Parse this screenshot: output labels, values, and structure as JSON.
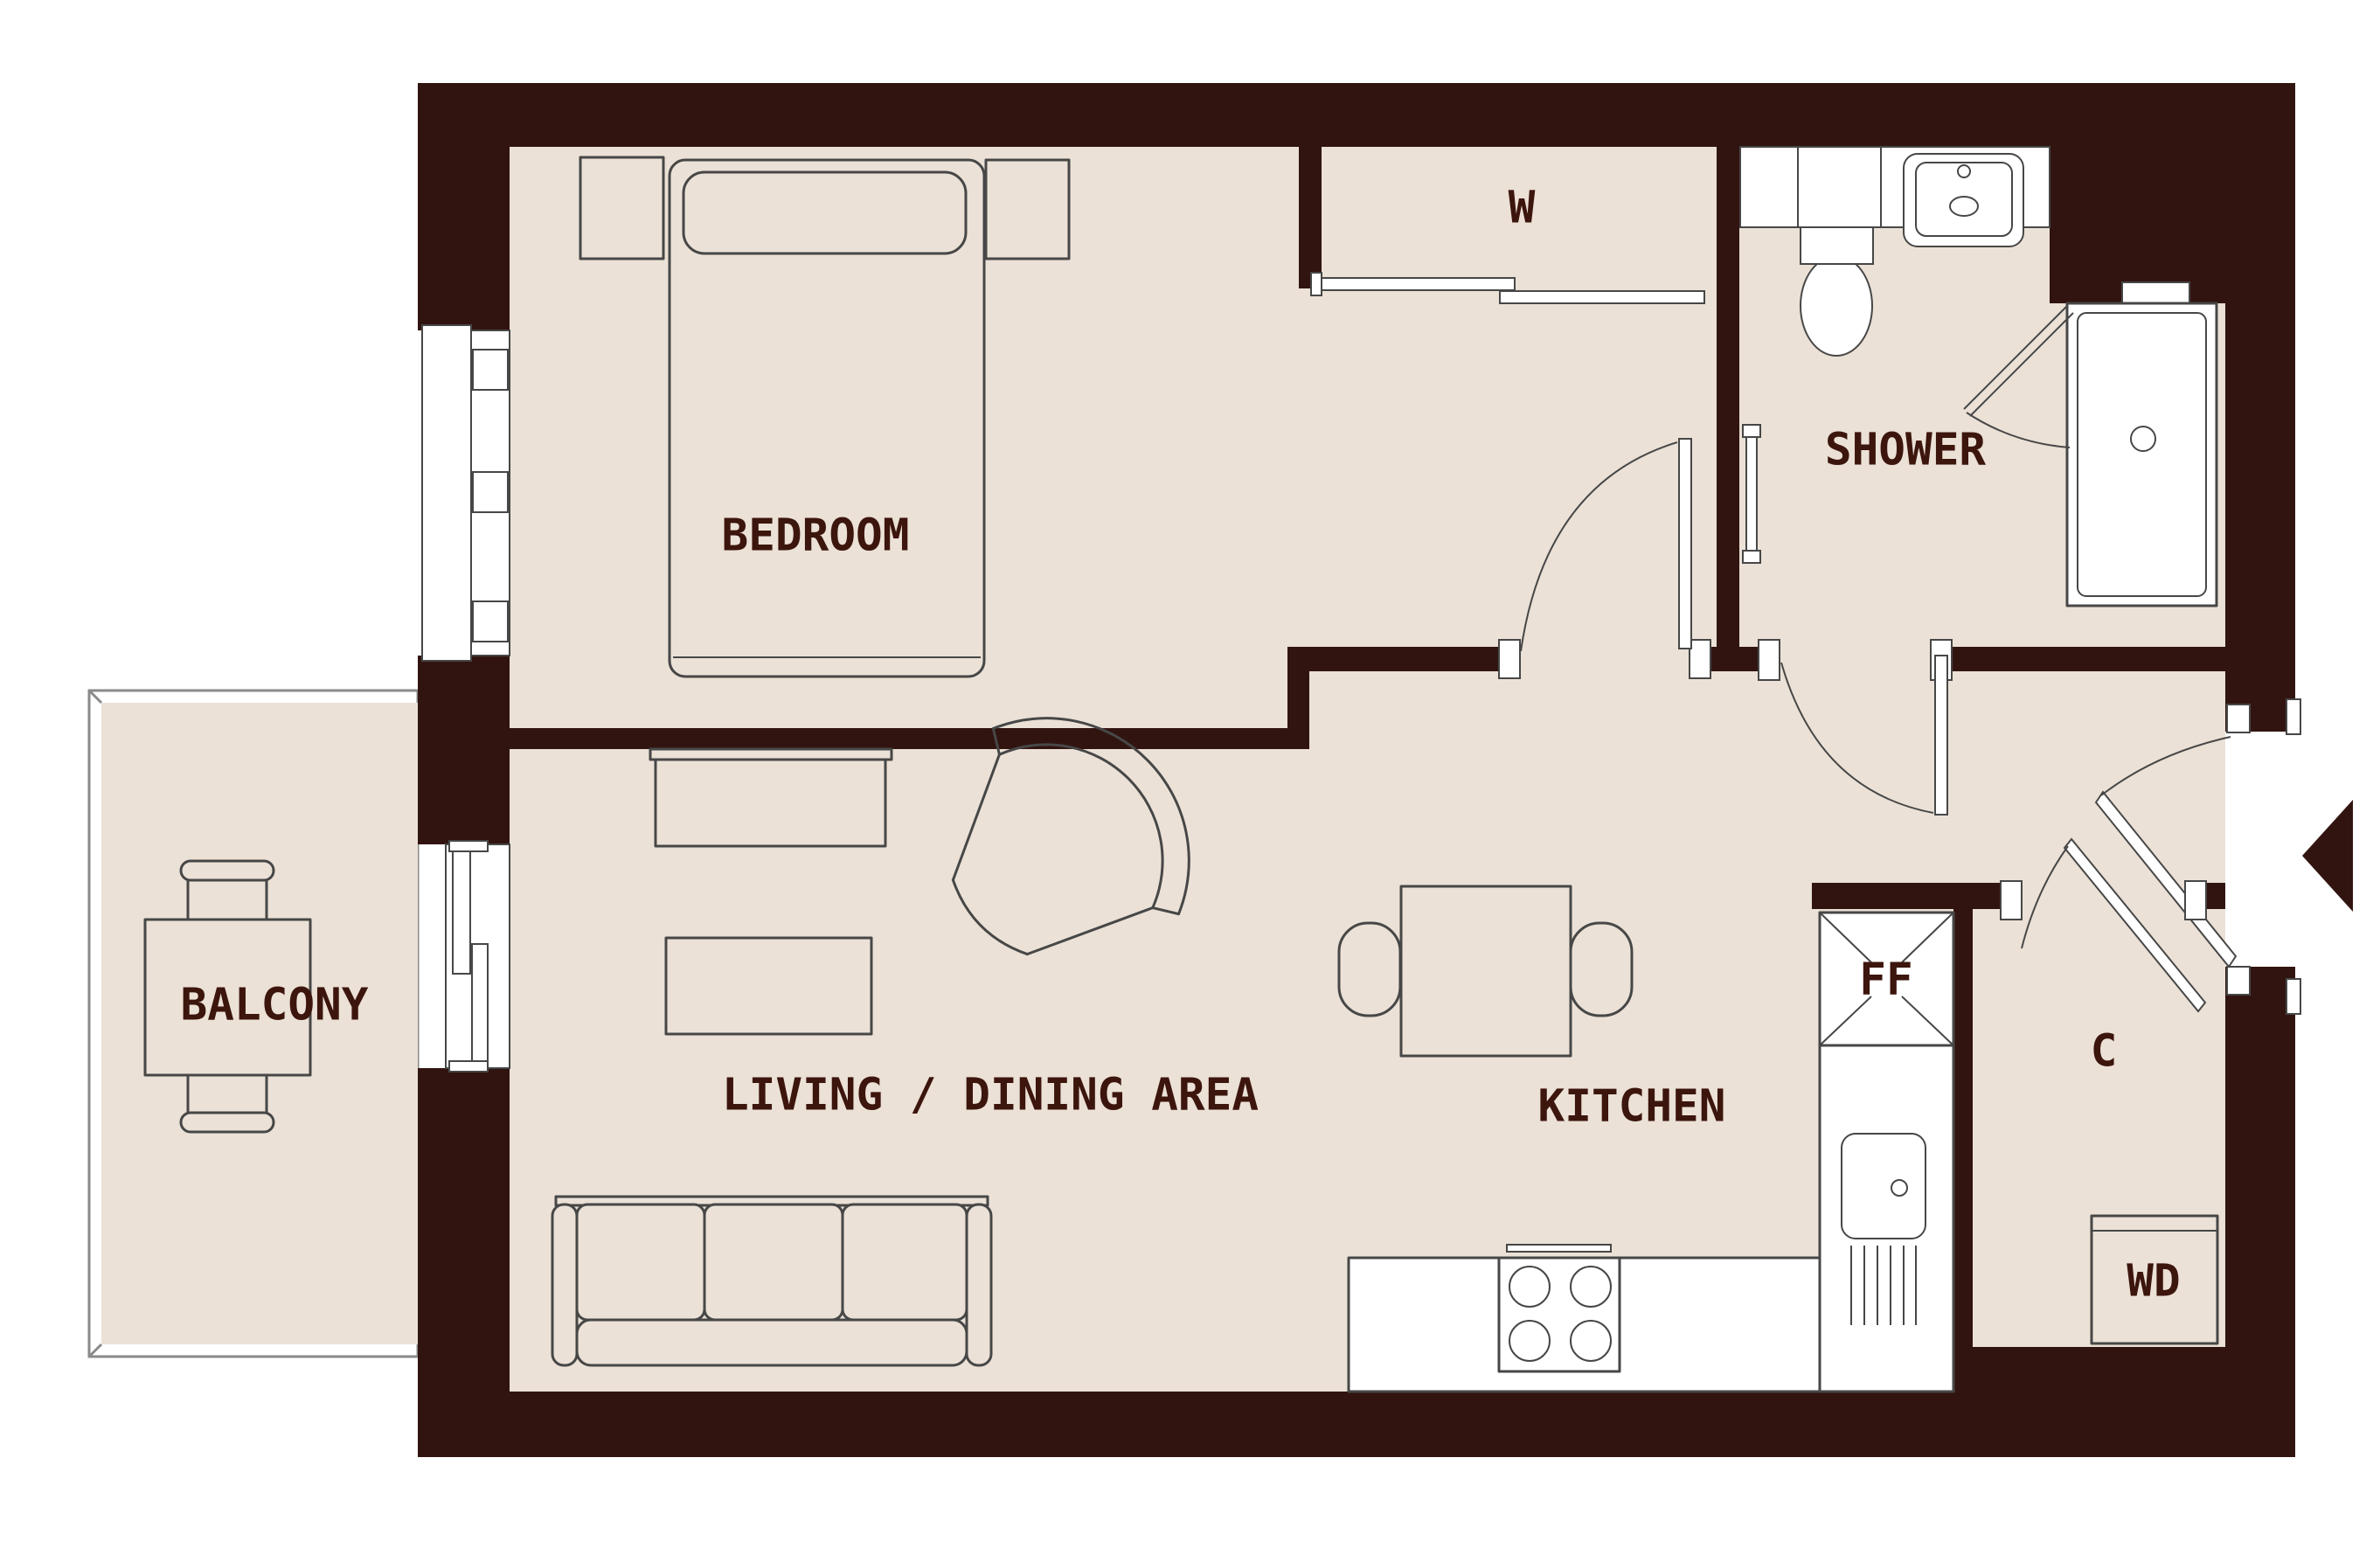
{
  "colors": {
    "wall": "#311410",
    "floor": "#EBE1D6",
    "label": "#3C150D",
    "line": "#474747",
    "lite": "#8a8a8a",
    "white": "#ffffff"
  },
  "rooms": {
    "bedroom": {
      "label": "BEDROOM"
    },
    "shower": {
      "label": "SHOWER"
    },
    "balcony": {
      "label": "BALCONY"
    },
    "living_dining": {
      "label": "LIVING / DINING AREA"
    },
    "kitchen": {
      "label": "KITCHEN"
    }
  },
  "fixtures": {
    "wardrobe": {
      "label": "W"
    },
    "fridge_freezer": {
      "label": "FF"
    },
    "cupboard": {
      "label": "C"
    },
    "washer_dryer": {
      "label": "WD"
    }
  }
}
